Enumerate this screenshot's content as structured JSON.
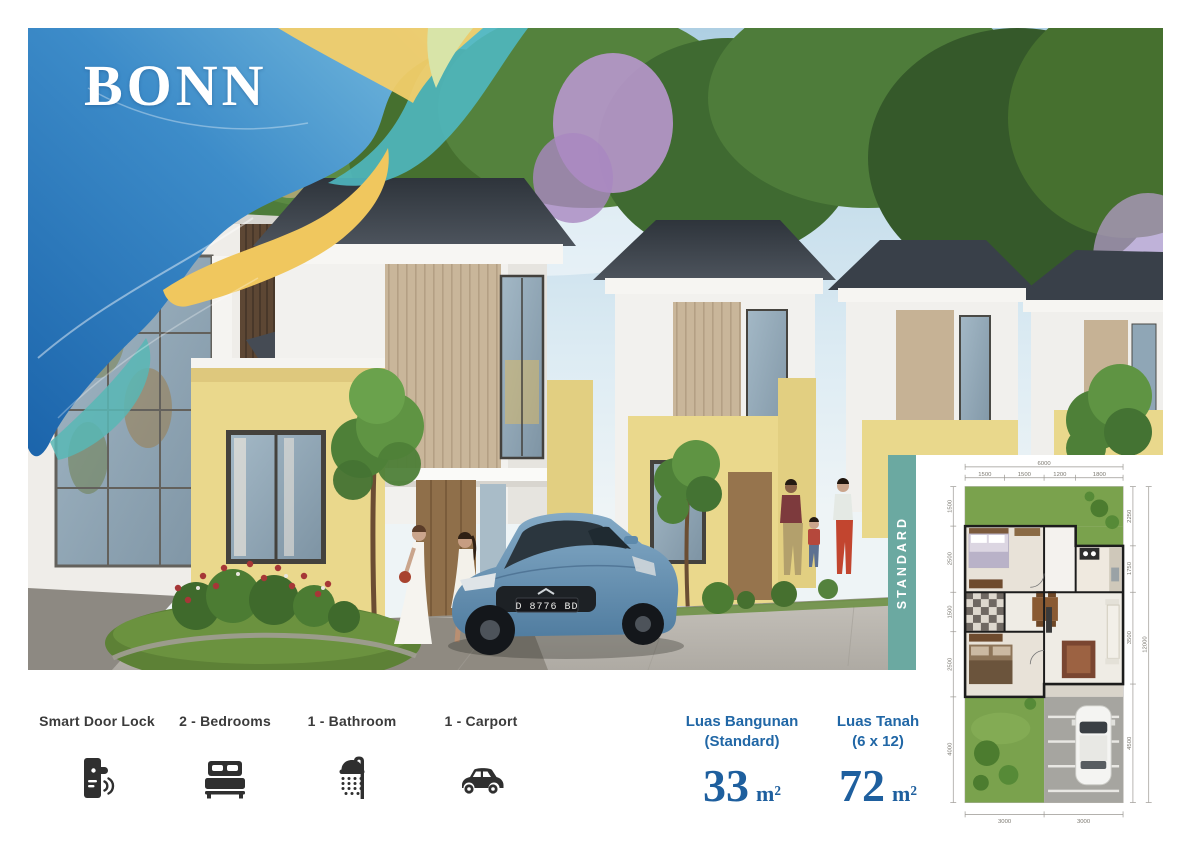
{
  "title": "BONN",
  "plan_tab": {
    "label": "STANDARD"
  },
  "features": [
    {
      "name": "smart-door-lock",
      "label": "Smart Door Lock"
    },
    {
      "name": "bedrooms",
      "label": "2 - Bedrooms"
    },
    {
      "name": "bathroom",
      "label": "1 - Bathroom"
    },
    {
      "name": "carport",
      "label": "1 - Carport"
    }
  ],
  "areas": [
    {
      "title": "Luas Bangunan",
      "subtitle": "(Standard)",
      "value": "33",
      "unit": "m²"
    },
    {
      "title": "Luas Tanah",
      "subtitle": "(6 x 12)",
      "value": "72",
      "unit": "m²"
    }
  ],
  "scene": {
    "license_plate": "D 8776 BD"
  },
  "floor_plan": {
    "dims": {
      "top_total": "6000",
      "top": [
        "1500",
        "1500",
        "1200",
        "1800"
      ],
      "left": [
        "1500",
        "2500",
        "1500",
        "2500",
        "4000"
      ],
      "right": [
        "2250",
        "1750",
        "3500",
        "4500"
      ],
      "right_total": "12000",
      "bottom": [
        "3000",
        "3000"
      ]
    }
  },
  "colors": {
    "accent_blue": "#1e5f9e",
    "teal": "#6ba9a1",
    "icon": "#2f2f2f",
    "ribbon_blue": "#2e7cc0",
    "ribbon_teal": "#52b6c9",
    "ribbon_yellow": "#f0c75e"
  }
}
